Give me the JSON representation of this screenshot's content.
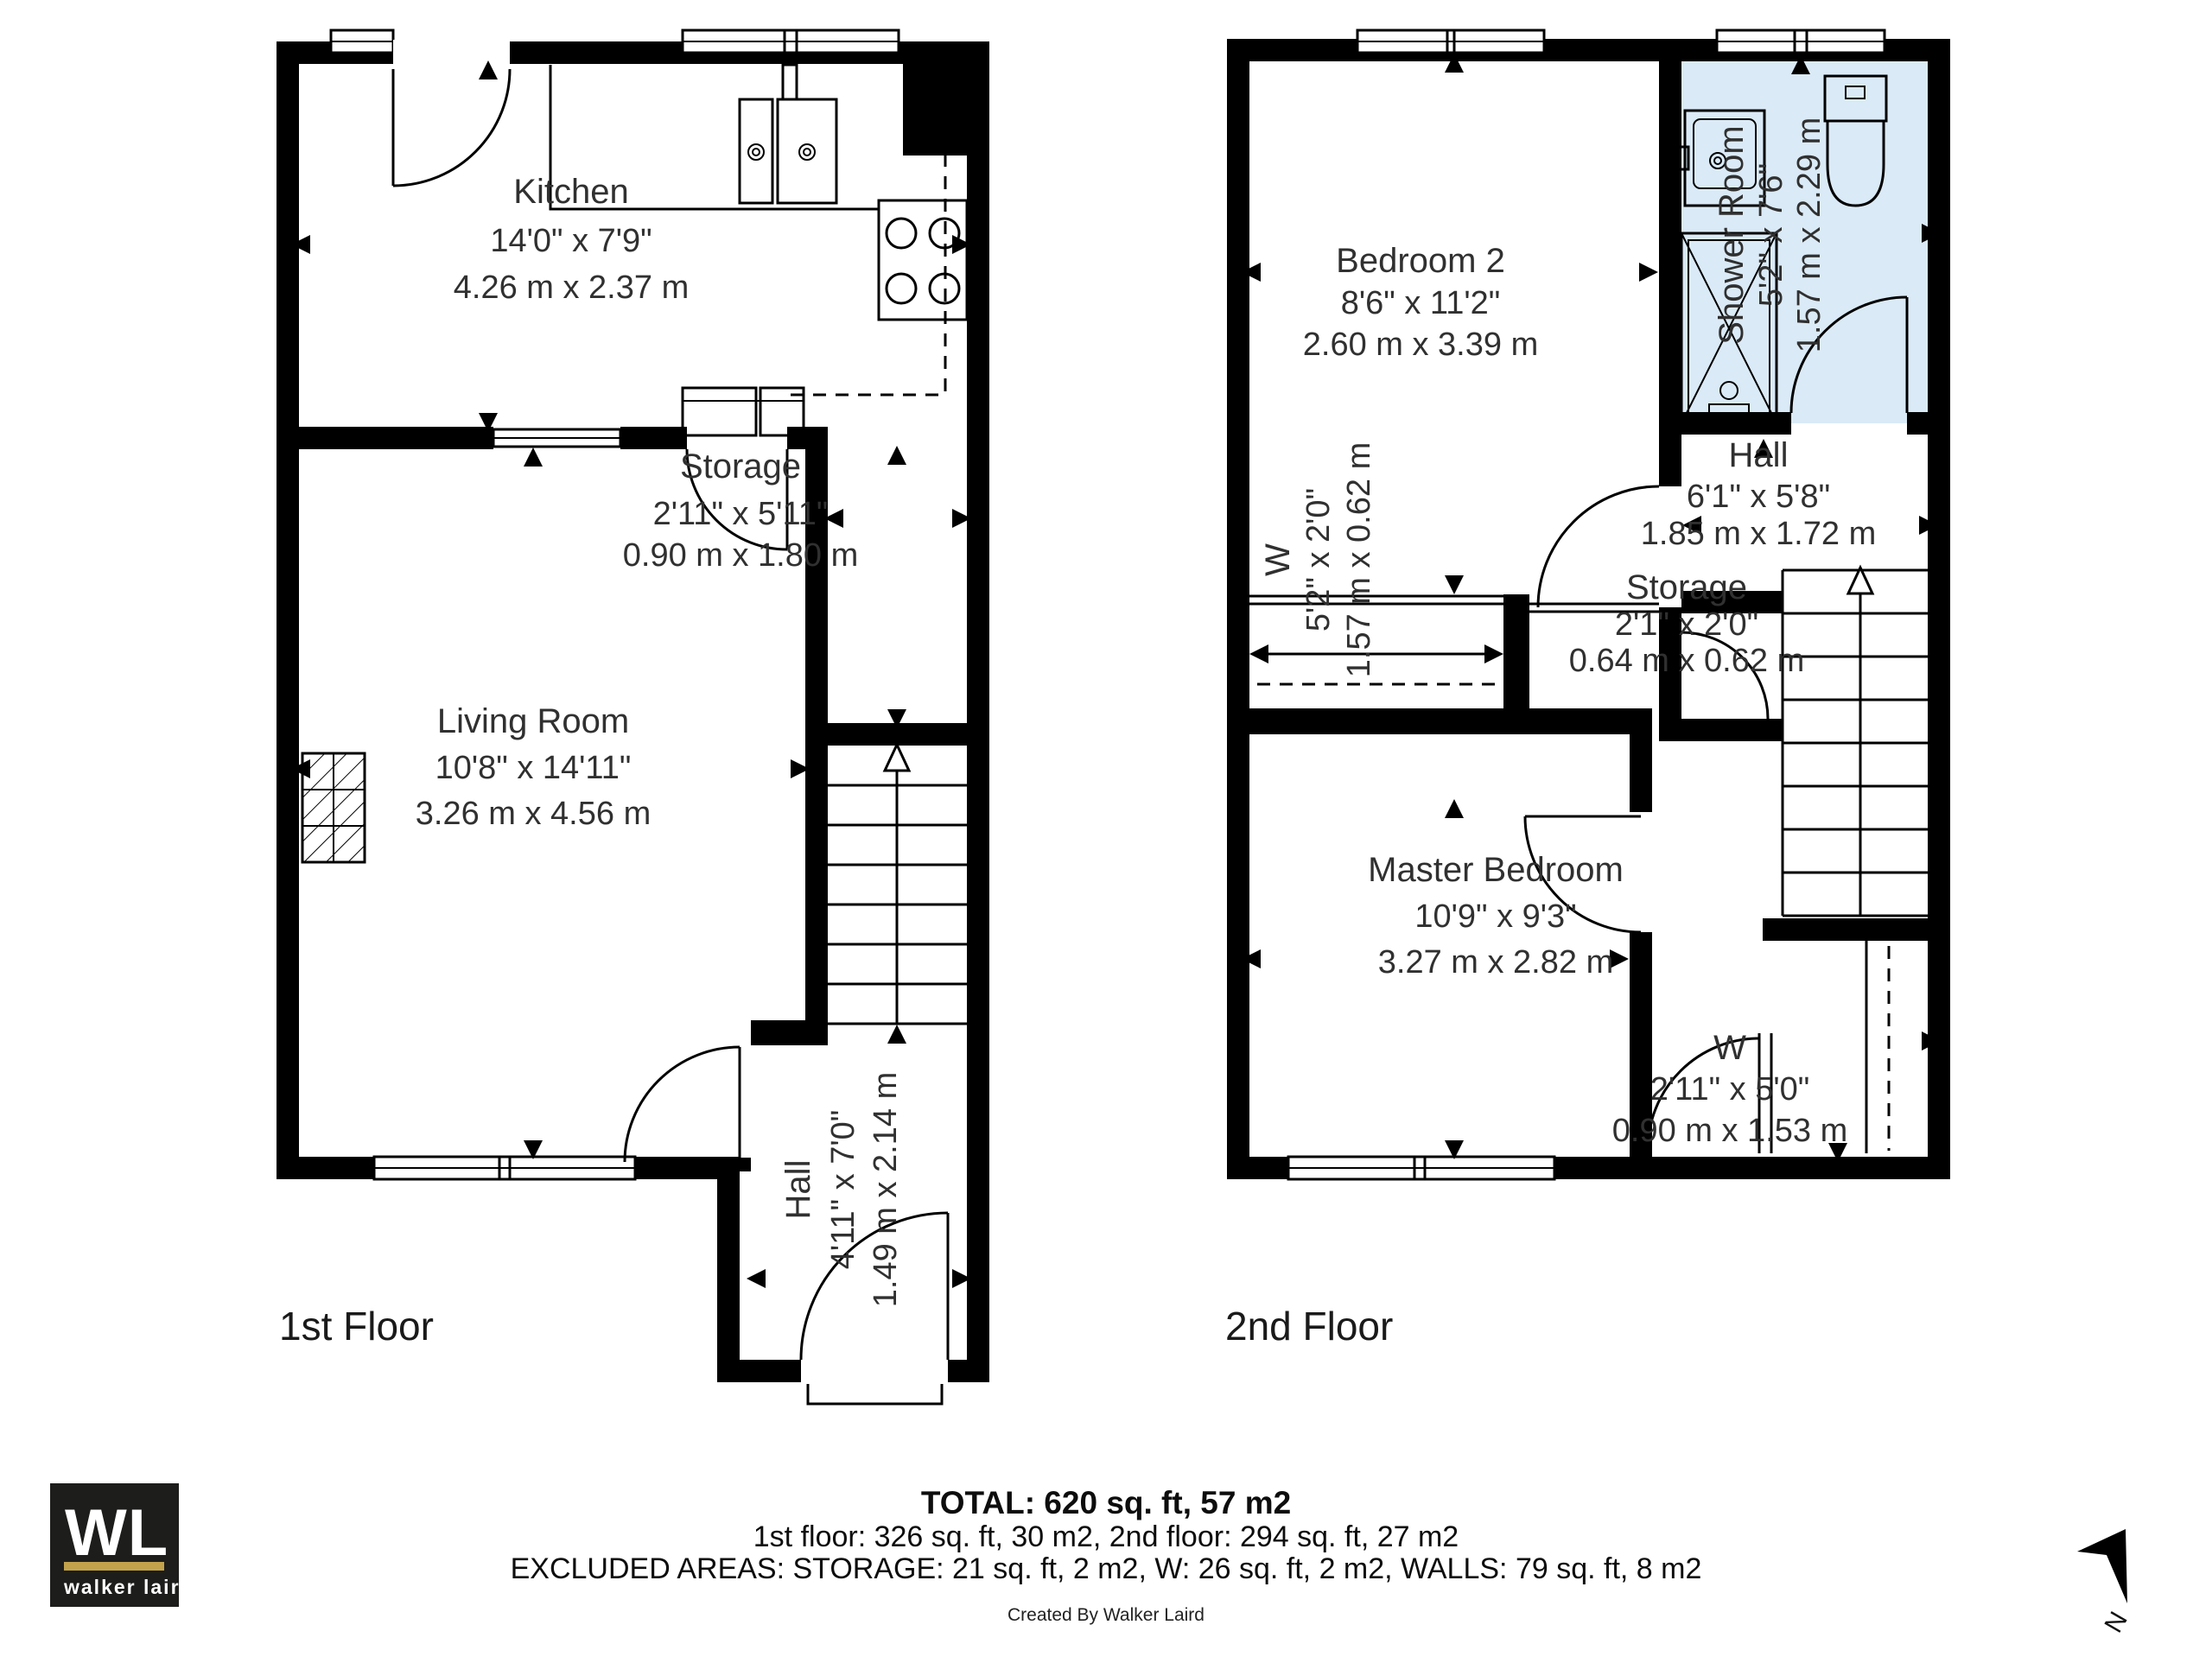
{
  "floors": [
    {
      "label": "1st Floor",
      "rooms": {
        "kitchen": {
          "name": "Kitchen",
          "imperial": "14'0\" x 7'9\"",
          "metric": "4.26 m x 2.37 m"
        },
        "storage": {
          "name": "Storage",
          "imperial": "2'11\" x 5'11\"",
          "metric": "0.90 m x 1.80 m"
        },
        "living": {
          "name": "Living Room",
          "imperial": "10'8\" x 14'11\"",
          "metric": "3.26 m x 4.56 m"
        },
        "hall": {
          "name": "Hall",
          "imperial": "4'11\" x 7'0\"",
          "metric": "1.49 m x 2.14 m"
        }
      }
    },
    {
      "label": "2nd Floor",
      "rooms": {
        "bedroom2": {
          "name": "Bedroom 2",
          "imperial": "8'6\" x 11'2\"",
          "metric": "2.60 m x 3.39 m"
        },
        "shower": {
          "name": "Shower Room",
          "imperial": "5'2\" x 7'6\"",
          "metric": "1.57 m x 2.29 m"
        },
        "hall": {
          "name": "Hall",
          "imperial": "6'1\" x 5'8\"",
          "metric": "1.85 m x 1.72 m"
        },
        "wardrobe": {
          "name": "W",
          "imperial": "5'2\" x 2'0\"",
          "metric": "1.57 m x 0.62 m"
        },
        "storage": {
          "name": "Storage",
          "imperial": "2'1\" x 2'0\"",
          "metric": "0.64 m x 0.62 m"
        },
        "master": {
          "name": "Master Bedroom",
          "imperial": "10'9\" x 9'3\"",
          "metric": "3.27 m x 2.82 m"
        },
        "wardrobe2": {
          "name": "W",
          "imperial": "2'11\" x 5'0\"",
          "metric": "0.90 m x 1.53 m"
        }
      }
    }
  ],
  "footer": {
    "total": "TOTAL: 620 sq. ft, 57 m2",
    "floors_line": "1st floor: 326 sq. ft, 30 m2, 2nd floor: 294 sq. ft, 27 m2",
    "excluded_line": "EXCLUDED AREAS: STORAGE: 21 sq. ft, 2 m2, W: 26 sq. ft, 2 m2, WALLS: 79 sq. ft, 8 m2",
    "credit": "Created By Walker Laird"
  },
  "logo": {
    "initials": "WL",
    "name": "walker laird",
    "bg": "#1d1d1b",
    "accent": "#c2a24b"
  },
  "compass": {
    "label": "N"
  },
  "colors": {
    "wall": "#000000",
    "shower_fill": "#daeaf6",
    "text": "#303030"
  }
}
